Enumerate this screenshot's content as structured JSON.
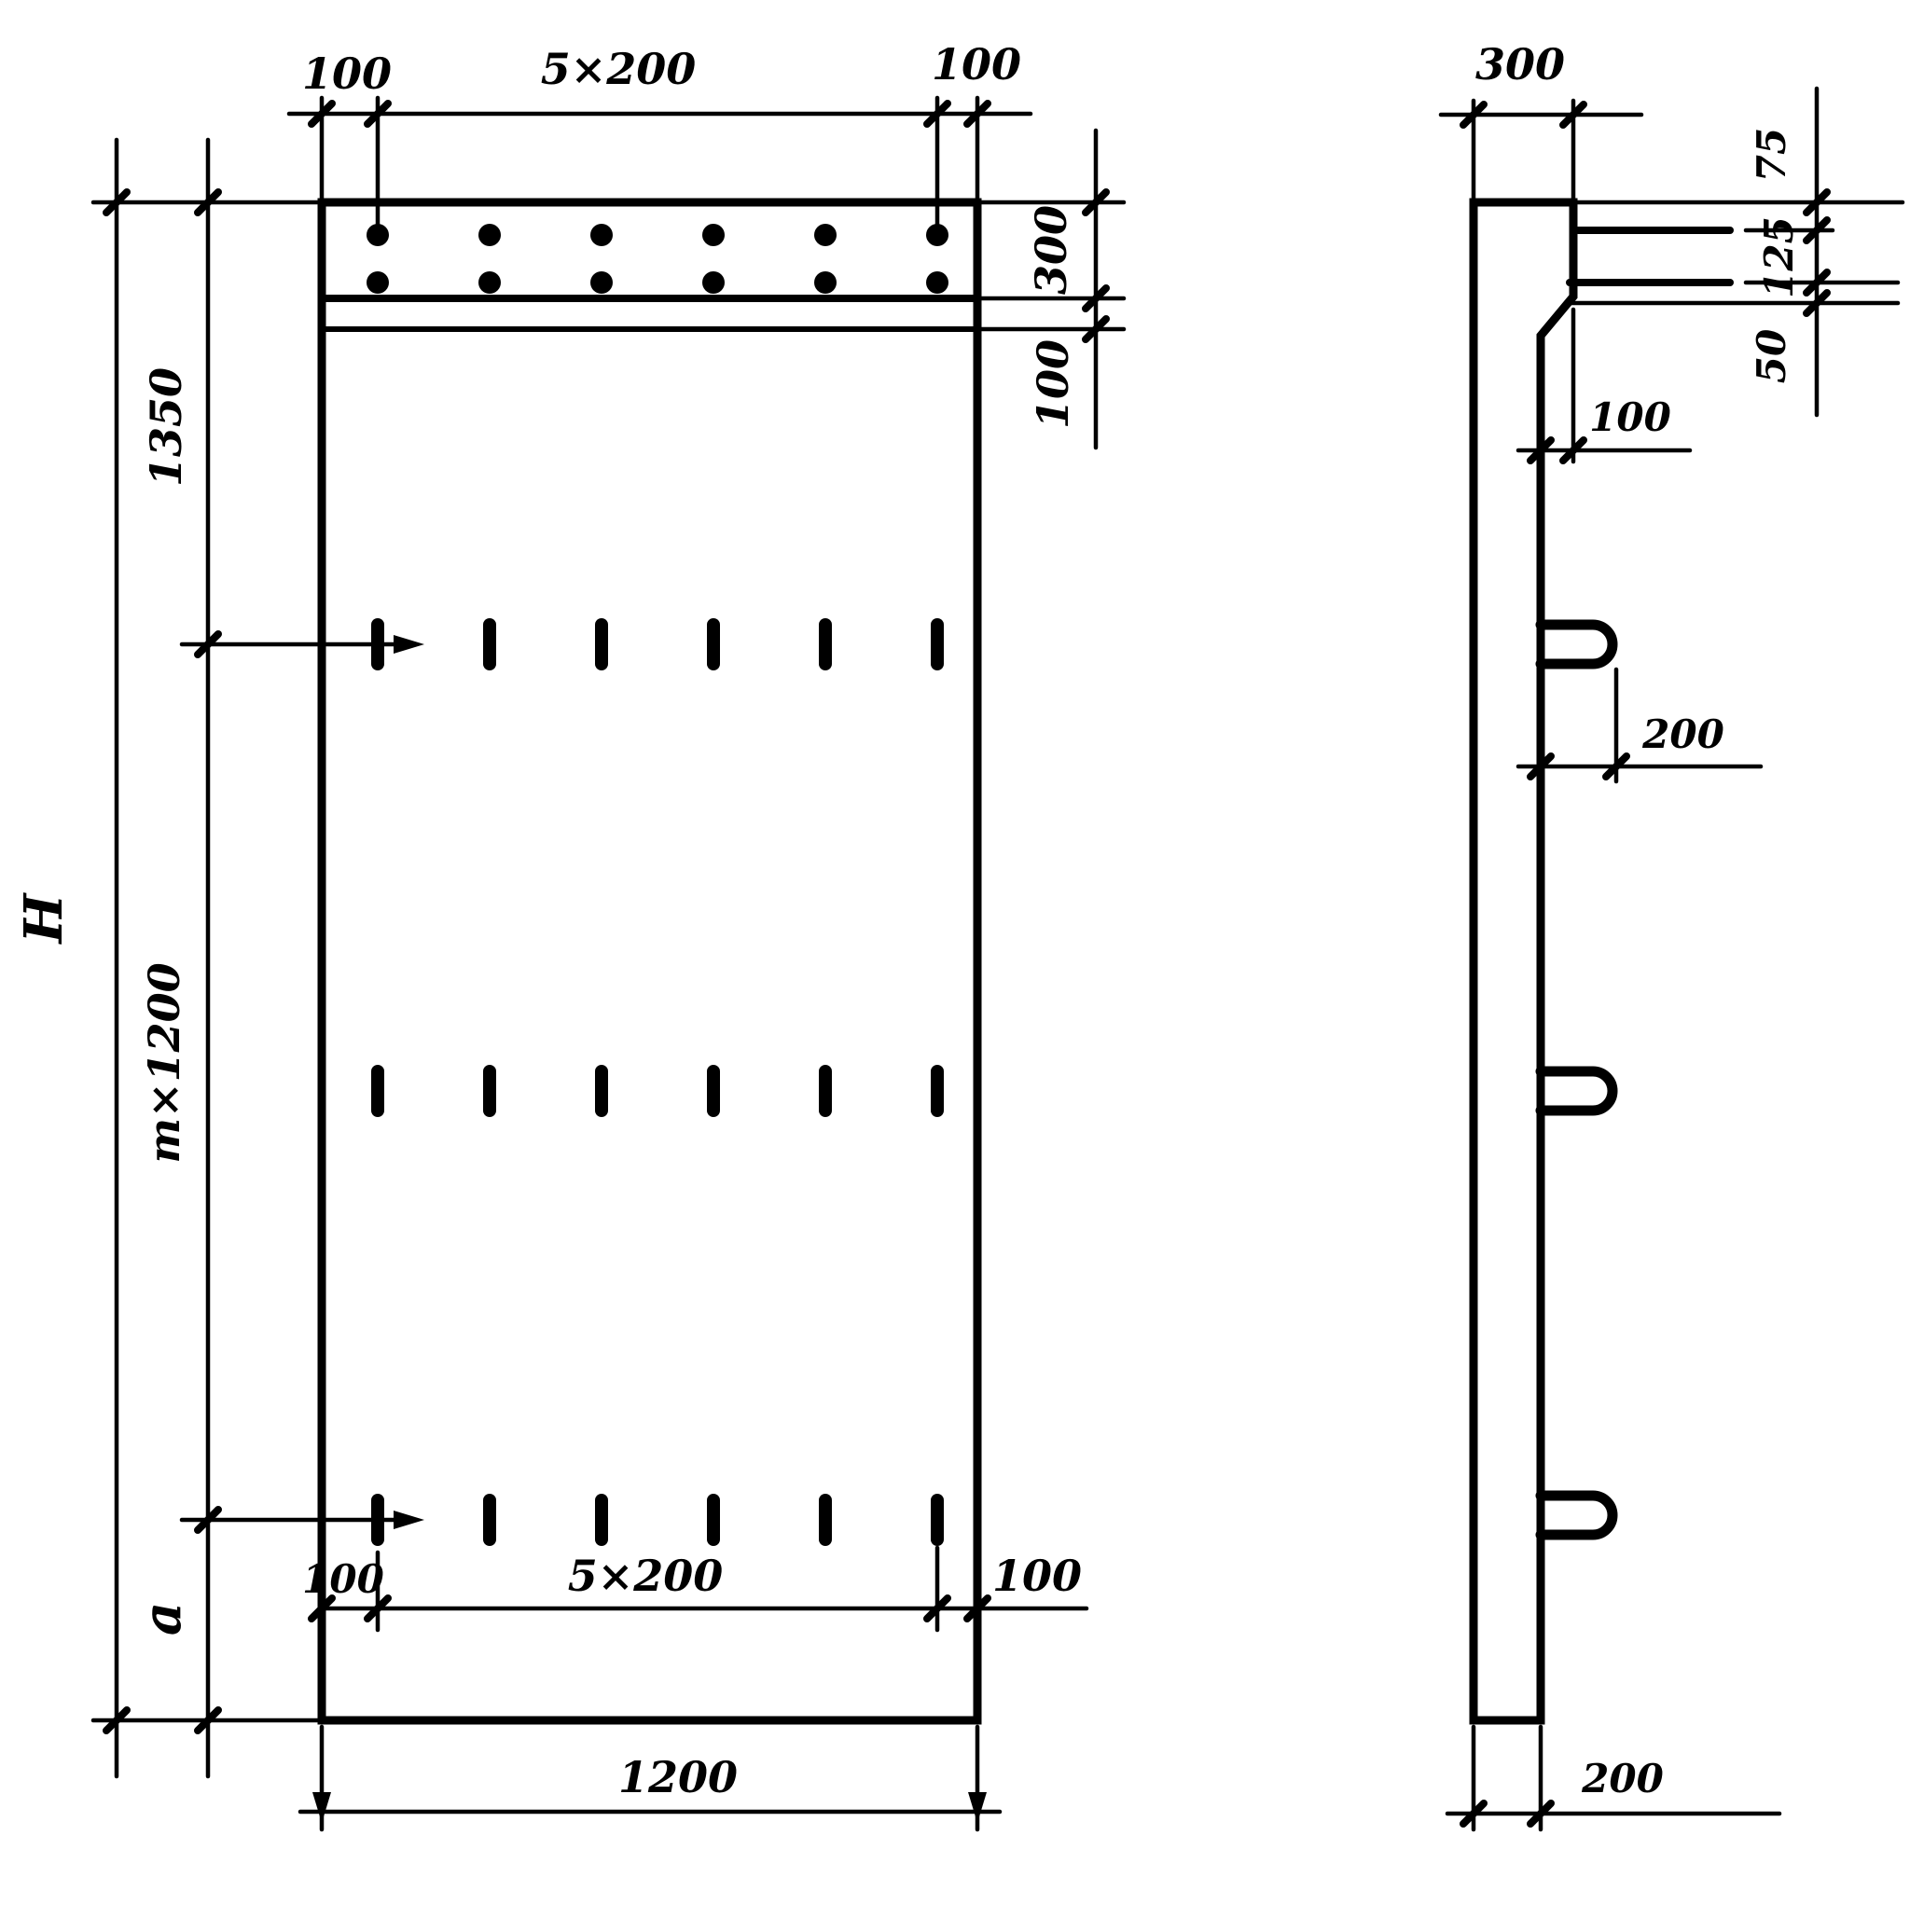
{
  "drawing": {
    "front_view": {
      "top_dim": {
        "left_margin": "100",
        "spacing": "5×200",
        "right_margin": "100"
      },
      "right_dim": {
        "strip_depth": "300",
        "strip_band": "100"
      },
      "left_dim": {
        "total_height": "H",
        "top_segment": "1350",
        "middle_segment": "m×1200",
        "bottom_segment": "a"
      },
      "bottom_inner_dim": {
        "left_margin": "100",
        "spacing": "5×200",
        "right_margin": "100"
      },
      "bottom_dim": {
        "width": "1200"
      }
    },
    "side_view": {
      "top_dim": {
        "depth": "300"
      },
      "dowel_dim": {
        "top": "75",
        "middle": "125",
        "bottom": "50"
      },
      "step_dim": {
        "offset": "100"
      },
      "loop_dim": {
        "length": "200"
      },
      "bottom_dim": {
        "depth": "200"
      }
    }
  }
}
